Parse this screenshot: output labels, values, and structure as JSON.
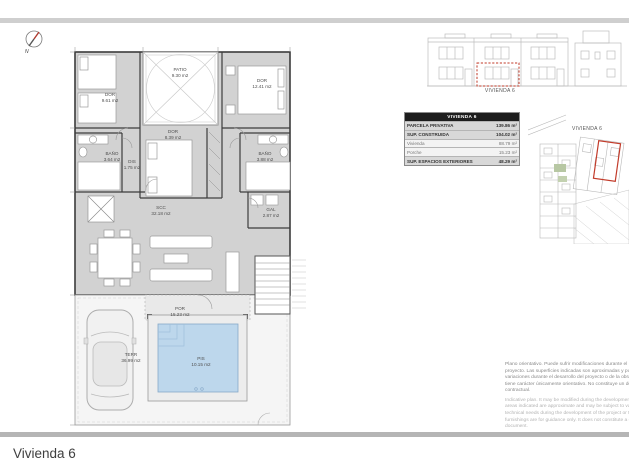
{
  "compass": {
    "label": "N"
  },
  "floor_plan": {
    "rooms": [
      {
        "id": "dor-1",
        "name": "DOR",
        "area": "9.61 m2"
      },
      {
        "id": "patio",
        "name": "PATIO",
        "area": "9.30 m2"
      },
      {
        "id": "dor-2",
        "name": "DOR",
        "area": "12.41 m2"
      },
      {
        "id": "bano-1",
        "name": "BAÑO",
        "area": "3.64 m2"
      },
      {
        "id": "dis",
        "name": "DIS",
        "area": "1.75 m2"
      },
      {
        "id": "dor-3",
        "name": "DOR",
        "area": "8.39 m2"
      },
      {
        "id": "bano-2",
        "name": "BAÑO",
        "area": "3.88 m2"
      },
      {
        "id": "gal",
        "name": "GAL",
        "area": "2.87 m2"
      },
      {
        "id": "scc",
        "name": "SCC",
        "area": "32.18 m2"
      },
      {
        "id": "por",
        "name": "POR",
        "area": "15.23 m2"
      },
      {
        "id": "terr",
        "name": "TERR",
        "area": "36.99 m2"
      },
      {
        "id": "pis",
        "name": "PIS",
        "area": "10.15 m2"
      }
    ]
  },
  "elevation": {
    "caption": "VIVIENDA 6"
  },
  "site_plan": {
    "caption": "VIVIENDA 6"
  },
  "summary_table": {
    "header": "VIVIENDA 6",
    "rows": [
      {
        "label": "PARCELA PRIVATIVA",
        "value": "139.86 m²"
      },
      {
        "label": "SUP. CONSTRUIDA",
        "value": "104.02 m²"
      },
      {
        "label": "Vivienda",
        "value": "88.79 m²"
      },
      {
        "label": "Porche",
        "value": "15.23 m²"
      },
      {
        "label": "SUP. ESPACIOS EXTERIORES",
        "value": "48.29 m²"
      }
    ]
  },
  "disclaimer": {
    "es": "Plano orientativo. Puede sufrir modificaciones durante el desarrollo del proyecto. Las superficies indicadas son aproximadas y pueden sufrir variaciones durante el desarrollo del proyecto o de la obra. El amueblamiento tiene carácter únicamente orientativo. No constituye un documento contractual.",
    "en": "Indicative plan. It may be modified during the development of the project. The areas indicated are approximate and may be subject to variations due to technical needs during the development of the project or the work. The furnishings are for guidance only. It does not constitute a contractual document."
  },
  "footer": {
    "title": "Vivienda 6"
  },
  "colors": {
    "highlight_red": "#c23b2a",
    "pool_blue": "#bdd7ec",
    "room_gray": "#d2d2d2",
    "site_green": "#b7c7a3"
  }
}
